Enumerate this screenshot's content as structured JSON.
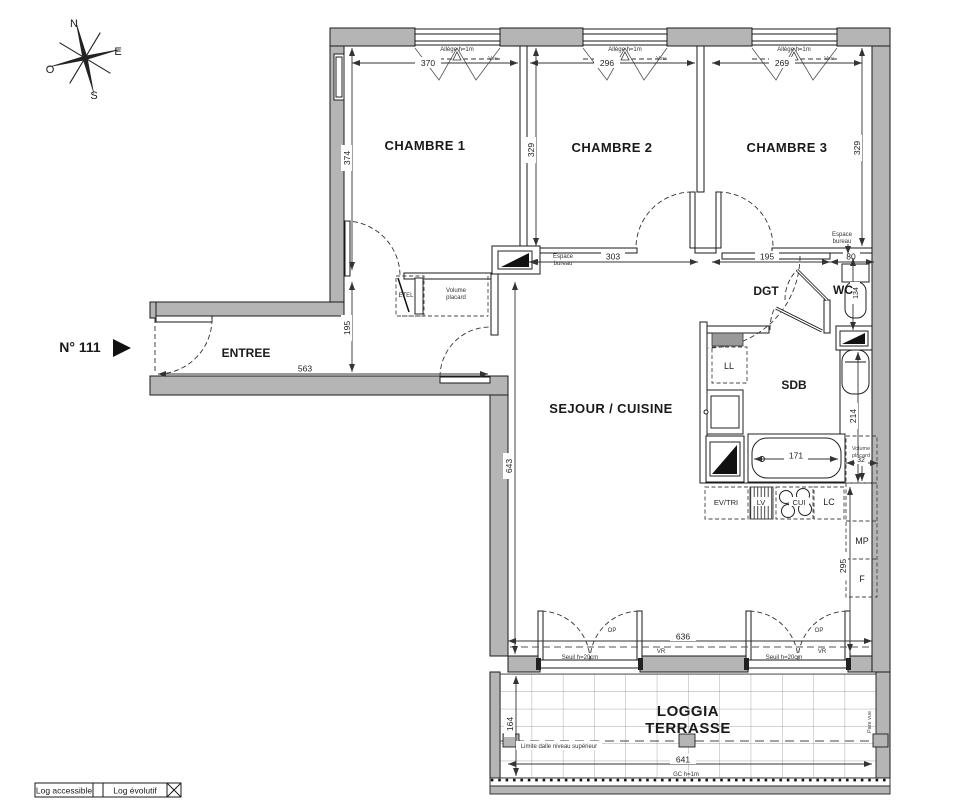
{
  "unit": {
    "number": "N° 111"
  },
  "compass": {
    "n": "N",
    "e": "E",
    "s": "S",
    "o": "O"
  },
  "rooms": {
    "chambre1": "CHAMBRE 1",
    "chambre2": "CHAMBRE 2",
    "chambre3": "CHAMBRE 3",
    "entree": "ENTREE",
    "sejour": "SEJOUR / CUISINE",
    "dgt": "DGT",
    "wc": "WC",
    "sdb": "SDB",
    "loggia_line1": "LOGGIA",
    "loggia_line2": "TERRASSE"
  },
  "labels": {
    "allege": "Allège h=1m",
    "vsu": "Vsu",
    "espace_l1": "Espace",
    "espace_l2": "bureau",
    "volume_l1": "Volume",
    "volume_l2": "placard",
    "etel": "ETEL",
    "ll": "LL",
    "ev_tri": "EV/TRI",
    "lv": "LV",
    "cui": "CUI",
    "lc": "LC",
    "mp": "MP",
    "f": "F",
    "op": "OP",
    "vr": "VR",
    "seuil": "Seuil h=20cm",
    "limite_dalle": "Limite dalle niveau supérieur",
    "gc": "GC h=1m",
    "pare_vue": "Pare vue"
  },
  "dims": {
    "ch1_w": "370",
    "ch1_d": "374",
    "ch2_w": "296",
    "ch2_d": "329",
    "ch3_w": "269",
    "ch3_d": "329",
    "ch2_bottom": "303",
    "dgt_w": "195",
    "dgt_r": "80",
    "entree_w": "563",
    "entree_d": "195",
    "sejour_d": "643",
    "sejour_w": "636",
    "bath": "171",
    "wc_d": "134",
    "sdb_d": "214",
    "placard": "32",
    "kitchen": "295",
    "loggia_d": "164",
    "loggia_w": "641"
  },
  "legend": {
    "accessible": "Log accessible",
    "evolutif": "Log évolutif"
  },
  "colors": {
    "wall_fill": "#b5b5b5",
    "line": "#1a1a1a",
    "background": "#ffffff"
  }
}
